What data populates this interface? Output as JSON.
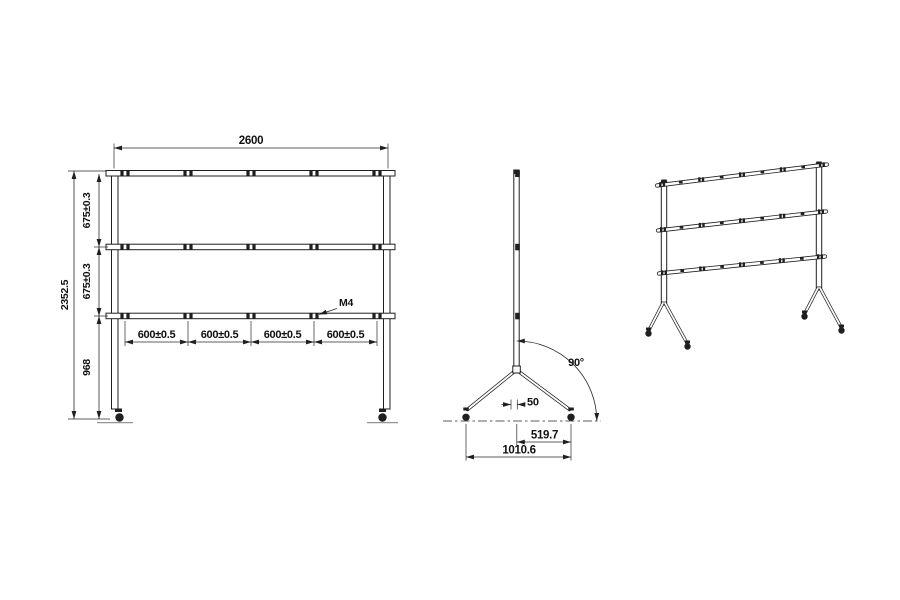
{
  "drawing": {
    "background": "#ffffff",
    "line_color": "#1f1f1f",
    "front": {
      "overall_width": "2600",
      "overall_height": "2352.5",
      "rail_gap_top": "675±0.3",
      "rail_gap_mid": "675±0.3",
      "leg_height": "968",
      "segments": [
        "600±0.5",
        "600±0.5",
        "600±0.5",
        "600±0.5"
      ],
      "thread_callout": "M4"
    },
    "side": {
      "leg_angle": "90°",
      "caster_offset": "50",
      "half_track": "519.7",
      "track": "1010.6"
    }
  }
}
